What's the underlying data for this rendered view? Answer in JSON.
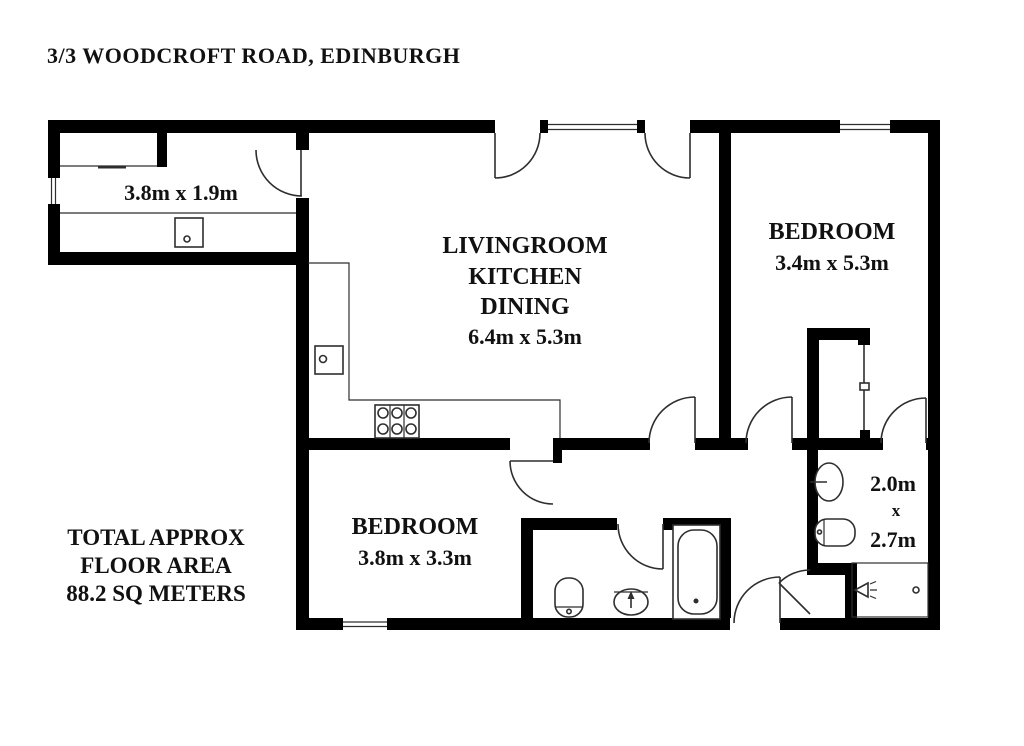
{
  "title": "3/3 WOODCROFT ROAD, EDINBURGH",
  "floor_area_note": {
    "line1": "TOTAL APPROX",
    "line2": "FLOOR AREA",
    "line3": "88.2 SQ METERS"
  },
  "rooms": {
    "utility_room": {
      "dims": "3.8m x 1.9m"
    },
    "living_kitchen_dining": {
      "label_line1": "LIVINGROOM",
      "label_line2": "KITCHEN",
      "label_line3": "DINING",
      "dims": "6.4m x 5.3m"
    },
    "bedroom_right": {
      "label": "BEDROOM",
      "dims": "3.4m x 5.3m"
    },
    "bedroom_left": {
      "label": "BEDROOM",
      "dims": "3.8m x 3.3m"
    },
    "ensuite_shower_room": {
      "dims_width": "2.0m",
      "dims_separator": "x",
      "dims_depth": "2.7m"
    }
  },
  "colors": {
    "background": "#ffffff",
    "walls": "#000000",
    "thin_lines": "#2e2e2e",
    "text": "#111111"
  }
}
